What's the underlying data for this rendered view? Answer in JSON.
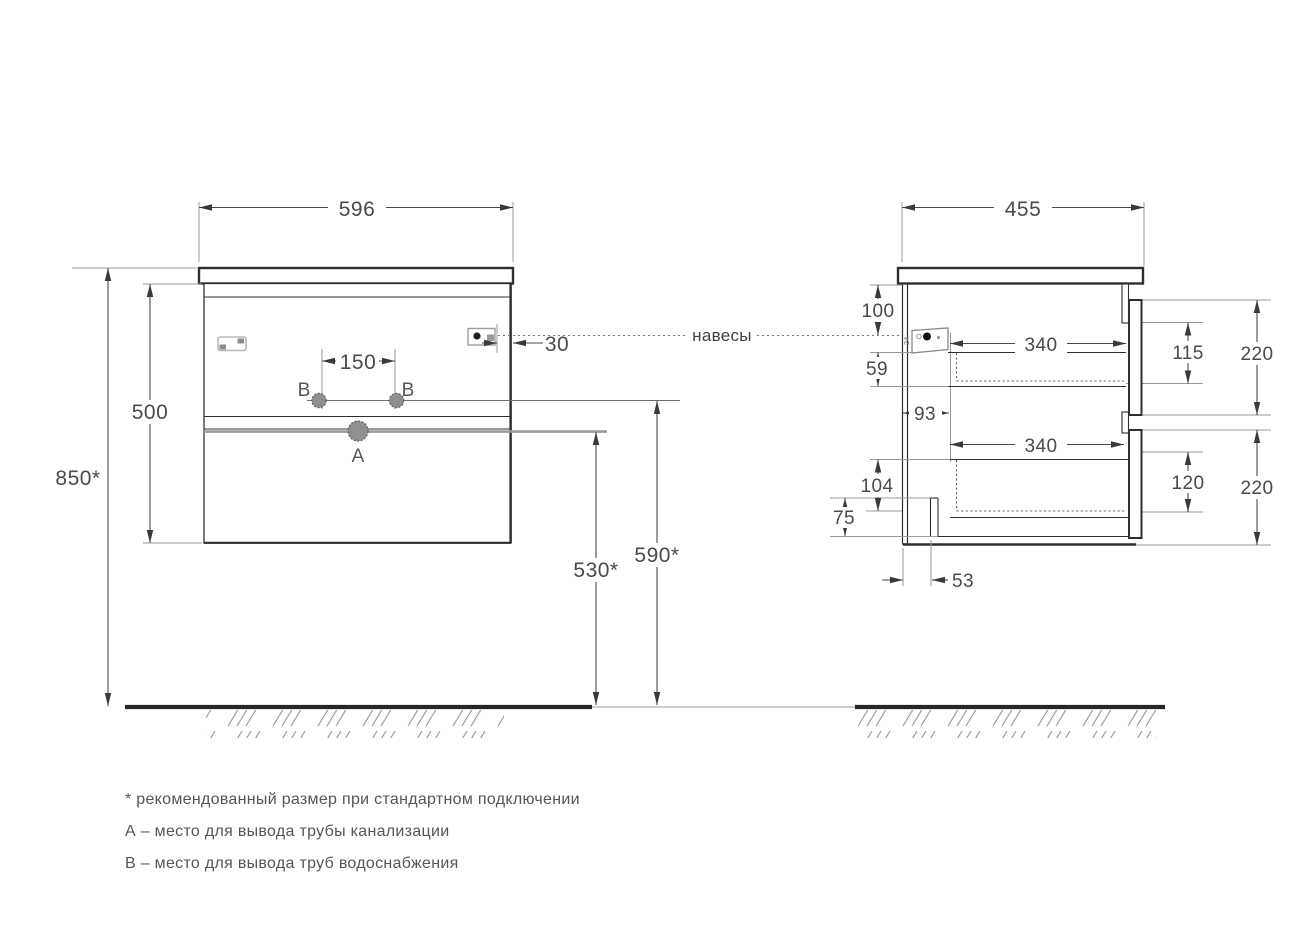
{
  "drawing": {
    "type": "furniture-installation-drawing",
    "views": [
      "front",
      "side"
    ]
  },
  "dims": {
    "front_width": "596",
    "front_height": "850*",
    "body_height": "500",
    "holes_spacing": "150",
    "hanger_inset": "30",
    "drain_height": "530*",
    "supply_height": "590*",
    "side_depth": "455",
    "hanger_top_offset": "100",
    "hanger_drop": "59",
    "back_clearance": "93",
    "upper_drawer_depth": "340",
    "lower_drawer_depth": "340",
    "upper_drawer_inner": "115",
    "upper_front_height": "220",
    "lower_drawer_inner": "120",
    "lower_front_height": "220",
    "siphon_clearance": "104",
    "bottom_rail": "75",
    "back_offset": "53"
  },
  "labels": {
    "hangers_line": "навесы",
    "point_a": "A",
    "point_b_left": "B",
    "point_b_right": "B",
    "hanger_detail": "24"
  },
  "legend": {
    "note_recommended": "* рекомендованный размер при стандартном подключении",
    "note_a": "А – место для вывода трубы канализации",
    "note_b": "В – место для вывода труб водоснабжения"
  },
  "colors": {
    "background": "#ffffff",
    "line_dark": "#2f2f2f",
    "line_gray": "#999999",
    "dim_text": "#4a4a4a",
    "legend_text": "#555555"
  }
}
